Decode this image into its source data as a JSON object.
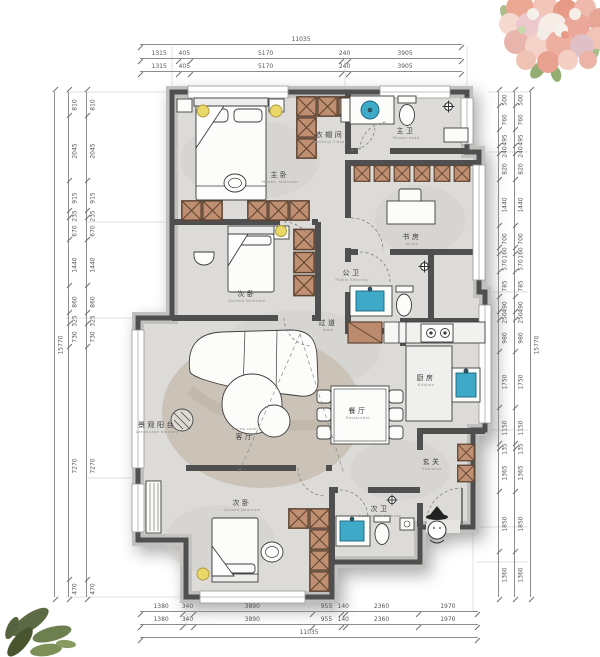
{
  "rooms": [
    {
      "id": "master-bedroom",
      "zh": "主卧",
      "en": "Master bedroom"
    },
    {
      "id": "walkin-closet",
      "zh": "衣帽间",
      "en": "Walking Closet"
    },
    {
      "id": "master-bath",
      "zh": "主卫",
      "en": "Master bath"
    },
    {
      "id": "study",
      "zh": "书房",
      "en": "Study"
    },
    {
      "id": "second-bedroom",
      "zh": "次卧",
      "en": "Second bedroom"
    },
    {
      "id": "public-bath",
      "zh": "公卫",
      "en": "Public Security"
    },
    {
      "id": "aisle",
      "zh": "过道",
      "en": "Aisle"
    },
    {
      "id": "kitchen",
      "zh": "厨房",
      "en": "Kitchen"
    },
    {
      "id": "dining",
      "zh": "餐厅",
      "en": "Restaurant"
    },
    {
      "id": "living",
      "zh": "客厅",
      "en": "Living room"
    },
    {
      "id": "balcony",
      "zh": "景观阳台",
      "en": "Landscape balcony"
    },
    {
      "id": "third-bedroom",
      "zh": "次卧",
      "en": "Second bedroom"
    },
    {
      "id": "second-bath",
      "zh": "次卫",
      "en": "Secondary defense"
    },
    {
      "id": "entrance",
      "zh": "玄关",
      "en": "Entrance"
    }
  ],
  "dims": {
    "top": {
      "total": "11035",
      "rows": [
        [
          "1315",
          "405",
          "5170",
          "240",
          "3905"
        ],
        [
          "1315",
          "405",
          "5170",
          "240",
          "3905"
        ]
      ]
    },
    "bottom": {
      "total": "11035",
      "rows": [
        [
          "1380",
          "340",
          "3890",
          "955",
          "140",
          "2360",
          "1970"
        ],
        [
          "1380",
          "340",
          "3890",
          "955",
          "140",
          "2360",
          "1970"
        ]
      ]
    },
    "left": {
      "total": "15770",
      "rows": [
        [
          "810",
          "2045",
          "915",
          "235",
          "670",
          "1440",
          "860",
          "325",
          "730",
          "7270",
          "470"
        ],
        [
          "810",
          "2045",
          "915",
          "235",
          "670",
          "1440",
          "860",
          "325",
          "730",
          "7270",
          "470"
        ]
      ]
    },
    "right": {
      "total": "15770",
      "rows": [
        [
          "500",
          "760",
          "495",
          "240",
          "820",
          "1440",
          "700",
          "160",
          "570",
          "785",
          "490",
          "250",
          "980",
          "1750",
          "1150",
          "135",
          "1365",
          "1850",
          "1360"
        ],
        [
          "500",
          "760",
          "495",
          "240",
          "820",
          "1440",
          "700",
          "160",
          "570",
          "785",
          "490",
          "250",
          "980",
          "1750",
          "1150",
          "135",
          "1365",
          "1850",
          "1360"
        ]
      ]
    }
  },
  "colors": {
    "wall_dark": "#4f4f4f",
    "wall_band": "#c2c0bd",
    "floor": "#dcdbd8",
    "wardrobe": "#c08e70",
    "wardrobe_line": "#5d4433",
    "fixture_blue": "#3fa9c8",
    "light_yellow": "#e9d867",
    "rug": "#cbc3b8",
    "dim_text": "#555555",
    "label_text": "#3a3a3a",
    "label_sub": "#8f8f8f"
  }
}
